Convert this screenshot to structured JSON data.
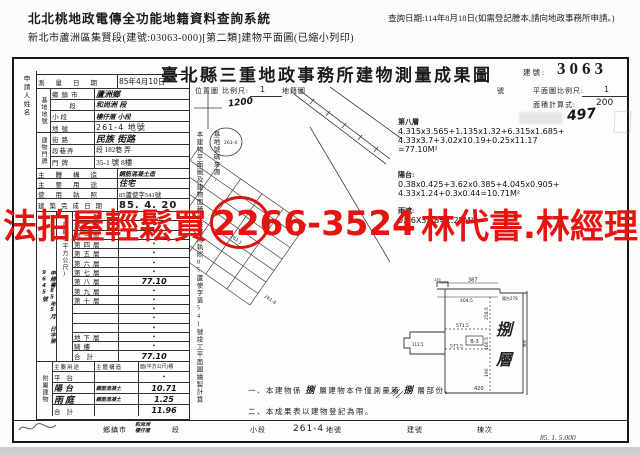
{
  "header": {
    "system_title": "北北桃地政電傳全功能地籍資料查詢系統",
    "query_date": "查詢日期:114年8月18日(如需登記謄本,請向地政事務所申請。)",
    "subtitle": "新北市蘆洲區集賢段(建號:03063-000)[第二類]建物平面圖(已縮小列印)"
  },
  "doc": {
    "title": "臺北縣三重地政事務所建物測量成果圖",
    "building_no_label": "建號:",
    "building_no": "3063",
    "form_code": "85. 1. 5.000"
  },
  "applicant": {
    "label": "申請人姓名",
    "doc_no": "申請書85年5月 日字第9645號"
  },
  "survey": {
    "date_label": "測量日期",
    "date_value": "85年4月10日"
  },
  "site": {
    "group_label": "基地地號",
    "rows": [
      {
        "label": "鄉鎮市",
        "value": "蘆洲鄉"
      },
      {
        "label": "段",
        "value": "和尚洲 段"
      },
      {
        "label": "小段",
        "value": "樓仔厝 小段"
      },
      {
        "label": "地號",
        "value": "261-4 地號"
      }
    ]
  },
  "address": {
    "group_label": "建物門牌",
    "rows": [
      {
        "label": "街路",
        "value": "民族 街路"
      },
      {
        "label": "段巷弄",
        "value": "段 182巷 弄"
      },
      {
        "label": "門牌",
        "value": "35-1 號 8樓"
      }
    ]
  },
  "building": {
    "structure_label": "主體構造",
    "structure_value": "鋼筋混凝土造",
    "use_label": "主要用途",
    "use_value": "住宅",
    "license_label": "使用執照",
    "license_value": "85蘆使字541號",
    "completion_label": "建築完成日期",
    "completion_value": "85. 4. 20"
  },
  "floor_area": {
    "group_label": "面積(平方公尺)",
    "rows": [
      {
        "label": "第一層",
        "value": "•"
      },
      {
        "label": "第二層",
        "value": "•"
      },
      {
        "label": "第三層",
        "value": "•"
      },
      {
        "label": "第四層",
        "value": "•"
      },
      {
        "label": "第五層",
        "value": "•"
      },
      {
        "label": "第六層",
        "value": "•"
      },
      {
        "label": "第七層",
        "value": "•"
      },
      {
        "label": "第八層",
        "value": "77.10"
      },
      {
        "label": "第九層",
        "value": "•"
      },
      {
        "label": "第十層",
        "value": "•"
      },
      {
        "label": "",
        "value": "•"
      },
      {
        "label": "",
        "value": "•"
      },
      {
        "label": "",
        "value": "•"
      },
      {
        "label": "地下層",
        "value": "•"
      },
      {
        "label": "騎樓",
        "value": "•"
      },
      {
        "label": "合計",
        "value": "77.10"
      }
    ]
  },
  "attached": {
    "group_label": "附屬建物",
    "headers": [
      "主要用途",
      "主體構造",
      "面(平方公尺)積"
    ],
    "rows": [
      {
        "use": "平台",
        "structure": "",
        "area": "•"
      },
      {
        "use": "陽台",
        "structure": "鋼筋混凝土",
        "area": "10.71"
      },
      {
        "use": "雨庭",
        "structure": "鋼筋混凝土",
        "area": "1.25"
      },
      {
        "use": "合計",
        "structure": "",
        "area": "11.96"
      }
    ]
  },
  "location_map": {
    "label": "位置圖",
    "scale_label": "比例尺:",
    "scale_num": "1",
    "scale_den": "1200",
    "cadastre_label": "地籍圖",
    "no_label": "號",
    "source_note": "基地號碼來源:",
    "basis_note": "本建物平面圖及建物面積係依使用執照85蘆使字第541號竣工平面圖繪製計算",
    "parcels": [
      "261-1",
      "261-4",
      "261-9"
    ]
  },
  "plan": {
    "scale_label": "平面圖比例尺:",
    "scale_num": "1",
    "scale_den": "200",
    "calc_label": "面積計算式:",
    "stamp": "497",
    "floor8_label": "第八層",
    "floor8_lines": [
      "4.315x3.565+1.135x1.32+6.315x1.685+",
      "4.33x3.7+3.02x10.19+0.25x11.17",
      "=77.10M²"
    ],
    "balcony_label": "陽台:",
    "balcony_lines": [
      "0.38x0.425+3.62x0.385+4.045x0.905+",
      "4.33x1.24+0.3x0.44=10.71M²"
    ],
    "canopy_label": "雨遮:",
    "canopy_line": "0.36X3.48=1.25M²",
    "floor_tag_1": "捌",
    "floor_tag_2": "層",
    "dims": {
      "n135": "135",
      "top": "387",
      "top2": "404.5",
      "balcony": "陽台278",
      "left": "112.5",
      "mid1": "571.5",
      "mid2": "571.5",
      "unit": "B-3",
      "bottom": "420",
      "v1": "258.5",
      "v2": "160.5",
      "v3": "190",
      "wall": "陽台"
    }
  },
  "notes": {
    "n1_pre": "一、本建物係",
    "n1_hw1": "捌",
    "n1_mid": "層建物本件僅測量第",
    "n1_hw2": "捌",
    "n1_post": "層部份。",
    "n2": "二、本成果表以建物登記為限。"
  },
  "bottom_row": {
    "township_label": "鄉鎮市",
    "township_hw1": "和尚洲",
    "township_hw2": "樓仔厝",
    "sec_label": "段",
    "subsec_label": "小段",
    "parcel": "261-4",
    "parcel_label": "地號",
    "bno_label": "建號",
    "unit_label": "棟次"
  },
  "overlay": {
    "ad_left": "法拍屋輕鬆買",
    "ad_phone": "2266-3524",
    "ad_right": "林代書.林經理",
    "color": "#e51410"
  }
}
